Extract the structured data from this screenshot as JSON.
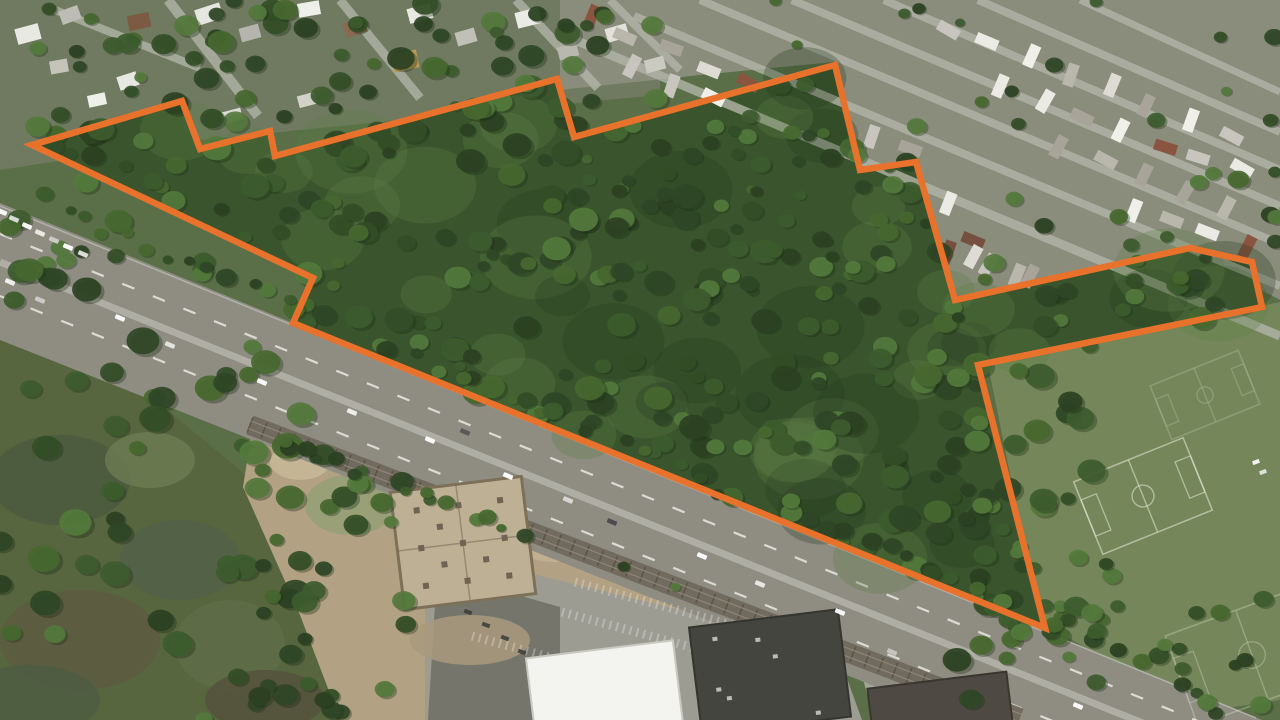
{
  "canvas": {
    "width": 1280,
    "height": 720
  },
  "map": {
    "type": "satellite-aerial-view",
    "overlay": {
      "name": "parcel-boundary",
      "color": "#E8722C",
      "stroke_width": 6.5,
      "points": [
        [
          32,
          145
        ],
        [
          182,
          101
        ],
        [
          200,
          149
        ],
        [
          270,
          131
        ],
        [
          275,
          156
        ],
        [
          557,
          79
        ],
        [
          574,
          137
        ],
        [
          835,
          65
        ],
        [
          860,
          170
        ],
        [
          916,
          162
        ],
        [
          955,
          300
        ],
        [
          1190,
          248
        ],
        [
          1252,
          262
        ],
        [
          1262,
          307
        ],
        [
          978,
          365
        ],
        [
          1045,
          628
        ],
        [
          293,
          323
        ],
        [
          313,
          278
        ]
      ]
    },
    "palette": {
      "base_green": "#5a6f47",
      "parcel_forest": "#3a552d",
      "suburb_ground": "#6f7a60",
      "trailer_ground": "#8a8d7c",
      "marsh_green": "#57663f",
      "field_green": "#75875a",
      "dirt": "#b2a183",
      "parking": "#9c9c92",
      "dark_lot": "#76756c",
      "asphalt": "#8f8d82",
      "median": "#b3b2a8",
      "rail_band": "#6e675b",
      "tie": "#57503f",
      "street": "#b2b4a8",
      "tree_palette": [
        "#2b4122",
        "#334e27",
        "#3d5c2e",
        "#47682f",
        "#547a3c",
        "#2f4726"
      ],
      "canopy_shadow": "#273d20",
      "canopy_light": "#5d7f45",
      "field_line": "rgba(238,243,228,0.55)"
    },
    "regions": [
      {
        "name": "suburb-ground",
        "color": "#6f7a60",
        "pts": [
          [
            0,
            0
          ],
          [
            660,
            0
          ],
          [
            660,
            95
          ],
          [
            400,
            120
          ],
          [
            180,
            142
          ],
          [
            0,
            170
          ]
        ]
      },
      {
        "name": "trailer-park-ground",
        "color": "#8a8d7c",
        "pts": [
          [
            560,
            0
          ],
          [
            1280,
            0
          ],
          [
            1280,
            300
          ],
          [
            1190,
            252
          ],
          [
            955,
            302
          ],
          [
            916,
            160
          ],
          [
            858,
            168
          ],
          [
            833,
            62
          ],
          [
            700,
            75
          ],
          [
            560,
            90
          ]
        ]
      },
      {
        "name": "marsh",
        "color": "#57663f",
        "pts": [
          [
            0,
            322
          ],
          [
            70,
            330
          ],
          [
            240,
            470
          ],
          [
            330,
            560
          ],
          [
            375,
            720
          ],
          [
            0,
            720
          ]
        ]
      },
      {
        "name": "sports-field",
        "color": "#75875a",
        "pts": [
          [
            988,
            365
          ],
          [
            1280,
            302
          ],
          [
            1280,
            700
          ],
          [
            1200,
            712
          ],
          [
            1040,
            622
          ]
        ]
      },
      {
        "name": "dirt-lot",
        "color": "#b2a183",
        "pts": [
          [
            252,
            430
          ],
          [
            640,
            556
          ],
          [
            702,
            612
          ],
          [
            702,
            720
          ],
          [
            340,
            720
          ],
          [
            300,
            615
          ],
          [
            243,
            487
          ]
        ]
      },
      {
        "name": "parking-lot",
        "color": "#9c9c92",
        "pts": [
          [
            468,
            558
          ],
          [
            836,
            648
          ],
          [
            862,
            720
          ],
          [
            425,
            720
          ],
          [
            425,
            600
          ]
        ]
      },
      {
        "name": "dark-parking-lot",
        "color": "#76756c",
        "pts": [
          [
            437,
            572
          ],
          [
            560,
            607
          ],
          [
            560,
            720
          ],
          [
            428,
            720
          ]
        ]
      },
      {
        "name": "side-street",
        "color": "#a3a399",
        "pts": [
          [
            838,
            586
          ],
          [
            864,
            596
          ],
          [
            910,
            720
          ],
          [
            874,
            720
          ]
        ]
      }
    ],
    "marsh_patches": [
      {
        "cx": 60,
        "cy": 480,
        "rx": 70,
        "ry": 45,
        "c": "#4b5a3e"
      },
      {
        "cx": 180,
        "cy": 560,
        "rx": 60,
        "ry": 40,
        "c": "#53624a"
      },
      {
        "cx": 80,
        "cy": 640,
        "rx": 80,
        "ry": 50,
        "c": "#5d5a41"
      },
      {
        "cx": 30,
        "cy": 700,
        "rx": 70,
        "ry": 35,
        "c": "#4e5c42"
      },
      {
        "cx": 230,
        "cy": 645,
        "rx": 55,
        "ry": 45,
        "c": "#5f6e49"
      },
      {
        "cx": 150,
        "cy": 460,
        "rx": 45,
        "ry": 28,
        "c": "#6d7c52"
      },
      {
        "cx": 265,
        "cy": 700,
        "rx": 60,
        "ry": 30,
        "c": "#55503c"
      }
    ],
    "dirt_patches": [
      {
        "cx": 350,
        "cy": 505,
        "rx": 45,
        "ry": 30,
        "c": "#94a077"
      },
      {
        "cx": 300,
        "cy": 462,
        "rx": 30,
        "ry": 18,
        "c": "#c7b999"
      },
      {
        "cx": 560,
        "cy": 540,
        "rx": 55,
        "ry": 22,
        "c": "#c3b392"
      },
      {
        "cx": 470,
        "cy": 640,
        "rx": 60,
        "ry": 25,
        "c": "#a99a7d"
      },
      {
        "cx": 415,
        "cy": 455,
        "rx": 26,
        "ry": 14,
        "c": "#a3946f"
      }
    ],
    "suburb_streets": [
      [
        168,
        0,
        258,
        116,
        10
      ],
      [
        340,
        0,
        420,
        98,
        9
      ],
      [
        516,
        0,
        598,
        88,
        9
      ],
      [
        55,
        10,
        200,
        68,
        8
      ],
      [
        610,
        0,
        680,
        70,
        8
      ]
    ],
    "trailer_streets": [
      [
        575,
        40,
        1280,
        336,
        9
      ],
      [
        634,
        16,
        1280,
        286,
        8
      ],
      [
        700,
        0,
        1280,
        244,
        8
      ],
      [
        792,
        0,
        1280,
        206,
        8
      ],
      [
        884,
        0,
        1280,
        170,
        8
      ],
      [
        978,
        0,
        1280,
        132,
        8
      ],
      [
        1080,
        0,
        1280,
        92,
        7
      ]
    ],
    "highway": {
      "band": [
        [
          0,
          203
        ],
        [
          1262,
          720
        ],
        [
          960,
          720
        ],
        [
          0,
          340
        ]
      ],
      "guardrail": {
        "x1": 0,
        "y1": 206,
        "x2": 1256,
        "y2": 718,
        "w": 1.5,
        "c": "#c9c9c0"
      },
      "median": {
        "x1": 0,
        "y1": 262,
        "x2": 1160,
        "y2": 730,
        "w": 7,
        "c": "#b3b2a8"
      },
      "dashes": [
        {
          "x1": 0,
          "y1": 234,
          "x2": 1215,
          "y2": 728,
          "w": 2.2,
          "dash": "13 20",
          "c": "#e9e9e3"
        },
        {
          "x1": 0,
          "y1": 296,
          "x2": 1075,
          "y2": 730,
          "w": 2.2,
          "dash": "13 20",
          "c": "#e9e9e3"
        }
      ]
    },
    "railroad": {
      "x1": 250,
      "y1": 425,
      "x2": 1020,
      "y2": 718,
      "band_w": 20,
      "band_c": "#6e675b",
      "tie_every": 15,
      "tie_len": 16,
      "tie_c": "#57503f"
    },
    "foundation": {
      "cx": 463,
      "cy": 543,
      "w": 132,
      "h": 118,
      "rot": -7,
      "fill": "#beb094",
      "stroke": "#7c7058",
      "piers": [
        [
          -42,
          -38
        ],
        [
          0,
          -38
        ],
        [
          42,
          -38
        ],
        [
          -42,
          0
        ],
        [
          0,
          0
        ],
        [
          42,
          0
        ],
        [
          -42,
          38
        ],
        [
          0,
          38
        ],
        [
          42,
          38
        ],
        [
          -21,
          -19
        ],
        [
          21,
          -19
        ],
        [
          -21,
          19
        ],
        [
          21,
          19
        ]
      ]
    },
    "buildings": [
      {
        "name": "white-retail-building",
        "cx": 605,
        "cy": 695,
        "w": 148,
        "h": 92,
        "rot": -7,
        "c": "#f3f3ef",
        "edge": "#c9c9c2"
      },
      {
        "name": "dark-roof-building",
        "cx": 770,
        "cy": 672,
        "w": 150,
        "h": 108,
        "rot": -7,
        "c": "#45453f",
        "edge": "#35352f"
      },
      {
        "name": "dark-roof-building-2",
        "cx": 940,
        "cy": 706,
        "w": 140,
        "h": 52,
        "rot": -7,
        "c": "#4e4a43",
        "edge": "#3a372f"
      }
    ],
    "parking_rows": [
      [
        575,
        582,
        838,
        654
      ],
      [
        562,
        612,
        820,
        682
      ],
      [
        472,
        636,
        560,
        660
      ]
    ],
    "houses": [
      [
        16,
        26,
        24,
        16,
        -15,
        "#e9e9e4"
      ],
      [
        60,
        8,
        20,
        14,
        -20,
        "#bdbdb5"
      ],
      [
        128,
        14,
        22,
        15,
        -12,
        "#7d5a42"
      ],
      [
        196,
        6,
        26,
        16,
        -18,
        "#e6e6e0"
      ],
      [
        240,
        26,
        20,
        14,
        -15,
        "#b5b5ad"
      ],
      [
        298,
        2,
        22,
        14,
        -10,
        "#efefea"
      ],
      [
        344,
        20,
        22,
        15,
        -18,
        "#8a6a4f"
      ],
      [
        408,
        6,
        24,
        15,
        -15,
        "#e9e9e3"
      ],
      [
        392,
        52,
        26,
        18,
        -12,
        "#b99a55"
      ],
      [
        456,
        30,
        20,
        14,
        -16,
        "#c0c0b7"
      ],
      [
        516,
        10,
        24,
        16,
        -14,
        "#ebebe5"
      ],
      [
        558,
        45,
        20,
        13,
        -15,
        "#b8b8af"
      ],
      [
        118,
        74,
        20,
        14,
        -18,
        "#e8e8e2"
      ],
      [
        50,
        60,
        18,
        13,
        -10,
        "#c4c4bb"
      ],
      [
        222,
        110,
        20,
        12,
        -15,
        "#dcdcd4"
      ],
      [
        298,
        94,
        18,
        12,
        -15,
        "#d2d2c9"
      ],
      [
        606,
        26,
        22,
        14,
        -16,
        "#e2e2db"
      ],
      [
        645,
        58,
        20,
        13,
        -15,
        "#cacac1"
      ],
      [
        88,
        94,
        18,
        12,
        -12,
        "#efefe9"
      ]
    ],
    "trailer_rows": [
      {
        "x": 588,
        "y": 16,
        "n": 9,
        "dx": 40,
        "dy": 17
      },
      {
        "x": 632,
        "y": 66,
        "n": 9,
        "dx": 40,
        "dy": 17
      },
      {
        "x": 690,
        "y": 122,
        "n": 8,
        "dx": 40,
        "dy": 17
      },
      {
        "x": 775,
        "y": 180,
        "n": 7,
        "dx": 40,
        "dy": 16
      },
      {
        "x": 905,
        "y": 240,
        "n": 6,
        "dx": 42,
        "dy": 12
      },
      {
        "x": 950,
        "y": 28,
        "n": 8,
        "dx": 40,
        "dy": 15
      },
      {
        "x": 1002,
        "y": 88,
        "n": 7,
        "dx": 40,
        "dy": 14
      },
      {
        "x": 1062,
        "y": 148,
        "n": 5,
        "dx": 42,
        "dy": 14
      },
      {
        "x": 1130,
        "y": 208,
        "n": 4,
        "dx": 40,
        "dy": 12
      }
    ],
    "trailer_colors": [
      "#eceae4",
      "#dddbd4",
      "#c7c5bd",
      "#8a5440",
      "#a8a49a",
      "#f1efe9",
      "#75503e",
      "#b9b6ac"
    ],
    "fields": [
      {
        "name": "soccer-pitch-main",
        "cx": 1143,
        "cy": 496,
        "w": 118,
        "h": 78,
        "rot": -22,
        "op": 0.9
      },
      {
        "name": "soccer-pitch-upper",
        "cx": 1205,
        "cy": 395,
        "w": 95,
        "h": 58,
        "rot": -22,
        "op": 0.35
      },
      {
        "name": "soccer-pitch-lower",
        "cx": 1252,
        "cy": 655,
        "w": 150,
        "h": 95,
        "rot": -20,
        "op": 0.5
      }
    ],
    "field_objects": [
      {
        "x": 1256,
        "y": 462,
        "c": "#f2f2ee"
      },
      {
        "x": 1263,
        "y": 472,
        "c": "#dfe0d8"
      }
    ],
    "vehicles": [
      {
        "x": 2,
        "y": 212,
        "c": "#ffffff"
      },
      {
        "x": 14,
        "y": 219,
        "c": "#dededa"
      },
      {
        "x": 27,
        "y": 226,
        "c": "#ffffff"
      },
      {
        "x": 40,
        "y": 233,
        "c": "#eeeee9"
      },
      {
        "x": 54,
        "y": 240,
        "c": "#cfcfc8"
      },
      {
        "x": 68,
        "y": 247,
        "c": "#ffffff"
      },
      {
        "x": 83,
        "y": 254,
        "c": "#e4e4df"
      },
      {
        "x": 10,
        "y": 282,
        "c": "#f4f4f0"
      },
      {
        "x": 40,
        "y": 300,
        "c": "#cfcfc8"
      },
      {
        "x": 120,
        "y": 318,
        "c": "#ffffff"
      },
      {
        "x": 170,
        "y": 345,
        "c": "#e8e8e2"
      },
      {
        "x": 262,
        "y": 382,
        "c": "#ffffff"
      },
      {
        "x": 352,
        "y": 412,
        "c": "#f2f2ee"
      },
      {
        "x": 430,
        "y": 440,
        "c": "#ffffff"
      },
      {
        "x": 465,
        "y": 432,
        "c": "#56565a"
      },
      {
        "x": 508,
        "y": 476,
        "c": "#ffffff"
      },
      {
        "x": 568,
        "y": 500,
        "c": "#dcdcd6"
      },
      {
        "x": 612,
        "y": 522,
        "c": "#4a4a4e"
      },
      {
        "x": 702,
        "y": 556,
        "c": "#ffffff"
      },
      {
        "x": 760,
        "y": 584,
        "c": "#ecece6"
      },
      {
        "x": 840,
        "y": 612,
        "c": "#ffffff"
      },
      {
        "x": 892,
        "y": 652,
        "c": "#c8c8c1"
      },
      {
        "x": 1078,
        "y": 706,
        "c": "#ffffff"
      }
    ],
    "dark_lot_cars": [
      [
        452,
        600
      ],
      [
        468,
        612
      ],
      [
        486,
        625
      ],
      [
        505,
        638
      ],
      [
        522,
        652
      ],
      [
        540,
        665
      ]
    ],
    "tree_patches": [
      {
        "x": 0,
        "y": 0,
        "w": 660,
        "h": 130,
        "n": 65,
        "rmin": 6,
        "rmax": 14
      },
      {
        "x": 0,
        "y": 120,
        "w": 150,
        "h": 210,
        "n": 24,
        "rmin": 7,
        "rmax": 15
      },
      {
        "x": 0,
        "y": 320,
        "w": 340,
        "h": 400,
        "n": 50,
        "rmin": 8,
        "rmax": 17
      },
      {
        "x": 560,
        "y": 0,
        "w": 720,
        "h": 295,
        "n": 60,
        "rmin": 5,
        "rmax": 11
      },
      {
        "x": 235,
        "y": 470,
        "w": 175,
        "h": 250,
        "n": 26,
        "rmin": 7,
        "rmax": 14
      },
      {
        "x": 950,
        "y": 345,
        "w": 165,
        "h": 375,
        "n": 42,
        "rmin": 7,
        "rmax": 15
      },
      {
        "x": 1020,
        "y": 598,
        "w": 260,
        "h": 122,
        "n": 20,
        "rmin": 6,
        "rmax": 12
      }
    ],
    "roadside_scatters": [
      {
        "x1": 0,
        "y1": 190,
        "x2": 1150,
        "y2": 668,
        "n": 48,
        "rmin": 5,
        "rmax": 11,
        "jitter": 14
      },
      {
        "x1": 250,
        "y1": 436,
        "x2": 700,
        "y2": 602,
        "n": 16,
        "rmin": 5,
        "rmax": 10,
        "jitter": 8
      }
    ],
    "parcel_trees": {
      "attempts": 700,
      "rmin": 6,
      "rmax": 15,
      "mottle_attempts": 130
    }
  }
}
